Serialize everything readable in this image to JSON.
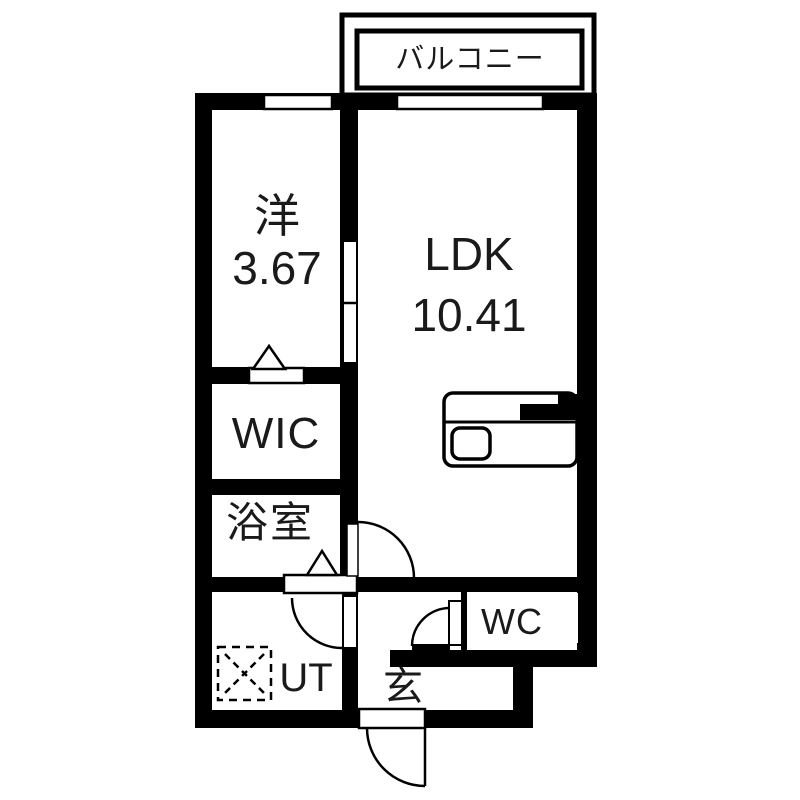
{
  "floorplan": {
    "balcony_label": "バルコニー",
    "western_room": {
      "label": "洋",
      "size": "3.67"
    },
    "ldk": {
      "label": "LDK",
      "size": "10.41"
    },
    "wic_label": "WIC",
    "bathroom_label": "浴室",
    "wc_label": "WC",
    "utility_label": "UT",
    "entrance_label": "玄"
  },
  "colors": {
    "wall": "#000000",
    "background": "#ffffff",
    "text": "#1a1a1a"
  }
}
